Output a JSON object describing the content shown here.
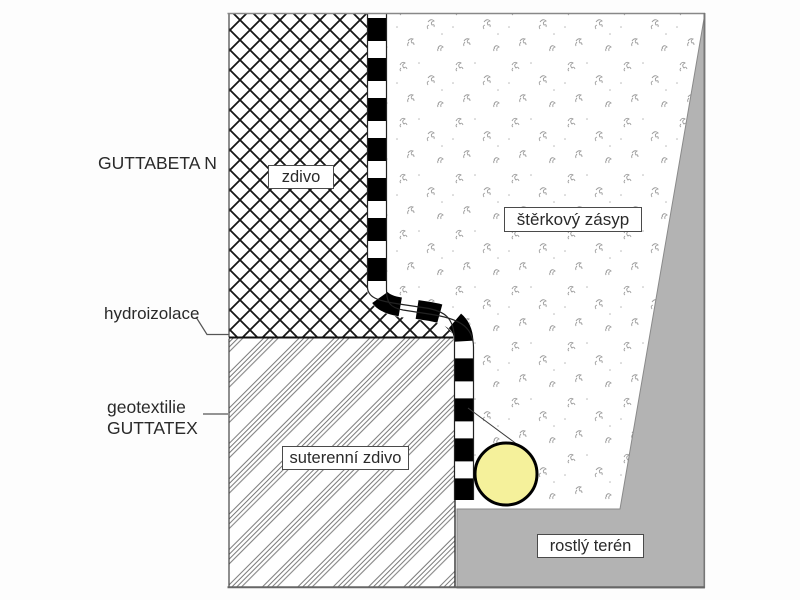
{
  "diagram": {
    "title": "Basement waterproofing detail (GUTTABETA N)",
    "labels": {
      "product": "GUTTABETA N",
      "wall": "zdivo",
      "gravel_backfill": "štěrkový zásyp",
      "waterproofing": "hydroizolace",
      "geotextile_line1": "geotextilie",
      "geotextile_line2": "GUTTATEX",
      "basement_wall": "suterenní zdivo",
      "natural_ground": "rostlý terén"
    },
    "colors": {
      "drain_pipe_fill": "#f5f19b",
      "natural_ground_fill": "#b3b3b3",
      "membrane_color": "#000000",
      "line_color": "#444444",
      "background": "#ffffff"
    }
  }
}
